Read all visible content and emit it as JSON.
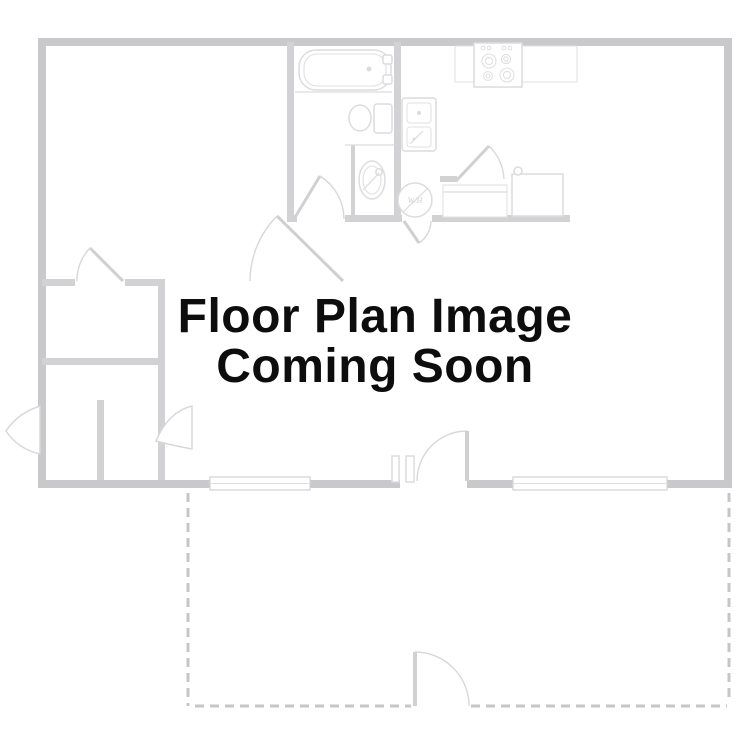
{
  "placeholder_text": {
    "line1": "Floor Plan Image",
    "line2": "Coming Soon"
  },
  "floor_plan": {
    "water_heater_label": "W/H",
    "fixtures": [
      "bathtub",
      "toilet",
      "pedestal-sink",
      "kitchen-sink",
      "stove",
      "refrigerator",
      "water-heater",
      "kitchen-counter",
      "closet-doors",
      "windows",
      "door-swings",
      "patio-dashed-outline",
      "patio-gate"
    ],
    "colors": {
      "wall": "#c9c9cc",
      "interior_wall": "#d2d2d5",
      "fixture_line": "#dcdcde",
      "door_line": "#d8d8da",
      "dashed_patio": "#c6c6c8",
      "window_border": "#d6d6d8",
      "text": "#0d0d0d",
      "background": "#ffffff"
    }
  }
}
